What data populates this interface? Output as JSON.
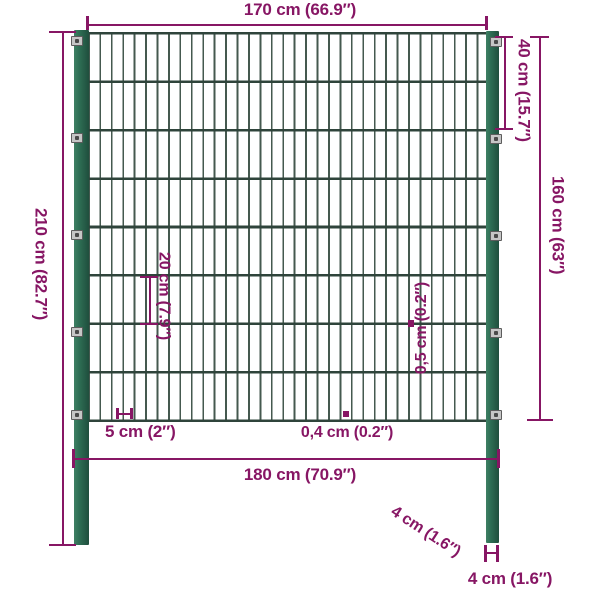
{
  "diagram": {
    "type": "fence-panel-with-posts-dimensions",
    "labels": {
      "mesh_width": "170 cm (66.9″)",
      "top_section_height": "40 cm (15.7″)",
      "panel_height": "160 cm (63″)",
      "total_height": "210 cm (82.7″)",
      "row_spacing": "20 cm (7.9″)",
      "horizontal_wire_thickness": "0,5 cm (0.2″)",
      "column_spacing": "5 cm (2″)",
      "vertical_wire_thickness": "0,4 cm (0.2″)",
      "outer_width": "180 cm (70.9″)",
      "post_depth": "4 cm (1.6″)",
      "post_width": "4 cm (1.6″)"
    },
    "colors": {
      "dimension": "#871664",
      "post": "#2e6e54",
      "post_light": "#3f8064",
      "post_dark": "#1f4e3d",
      "wire": "#45594f",
      "wire_dark": "#2f443b",
      "connector": "#c6c6c6",
      "background": "#ffffff"
    }
  }
}
